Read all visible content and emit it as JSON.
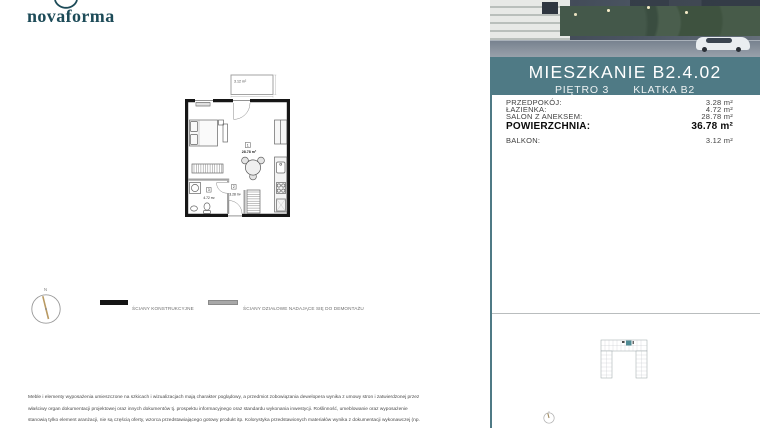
{
  "brand": {
    "name": "novaforma"
  },
  "header": {
    "title": "MIESZKANIE B2.4.02",
    "floor": "PIĘTRO 3",
    "staircase": "KLATKA B2"
  },
  "areas": {
    "rows": [
      {
        "label": "PRZEDPOKÓJ:",
        "value": "3.28 m²"
      },
      {
        "label": "ŁAZIENKA:",
        "value": "4.72 m²"
      },
      {
        "label": "SALON Z ANEKSEM:",
        "value": "28.78 m²"
      },
      {
        "label": "POWIERZCHNIA:",
        "value": "36.78 m²"
      },
      {
        "label": "BALKON:",
        "value": "3.12 m²"
      }
    ]
  },
  "plan": {
    "balcony_area": "3.12 m²",
    "rooms": [
      {
        "no": "1",
        "area": "28.78 m²"
      },
      {
        "no": "2",
        "area": "3.28 m²"
      },
      {
        "no": "3",
        "area": "4.72 m²"
      }
    ]
  },
  "legend": {
    "structural": "ŚCIANY KONSTRUKCYJNE",
    "partition": "ŚCIANY DZIAŁOWE NADAJĄCE SIĘ DO DEMONTAŻU"
  },
  "compass": {
    "north": "N"
  },
  "disclaimer": {
    "line1": "Meble i elementy wyposażenia umieszczone na szkicach i wizualizacjach mają charakter poglądowy, a przedmiot zobowiązania dewelopera wynika z umowy stron i zatwierdzonej przez",
    "line2": "właściwy organ dokumentacji projektowej oraz innych dokumentów tj. prospektu informacyjnego oraz standardu wykonania inwestycji. Roślinność, umeblowanie oraz wyposażenie",
    "line3": "stanowią tylko element aranżacji, nie są częścią oferty, wzorca przedstawiającego gotowy produkt itp. Kolorystyka przedstawionych materiałów wynika z dokumentacji wykonawczej (np.",
    "line4": "według skali RAL) ze wszystkimi jej zmianami. Wymiary pomieszczeń widoczne na szkicu zostały przepisane z dokumentacji projektowej i mogą nie być zgodne z rzeczywistością."
  },
  "colors": {
    "accent_teal": "#4f7a85",
    "brand_teal": "#1d4b58",
    "unit_highlight": "#4e8a93",
    "wall_black": "#161616",
    "partition_gray": "#a3a3a3"
  }
}
